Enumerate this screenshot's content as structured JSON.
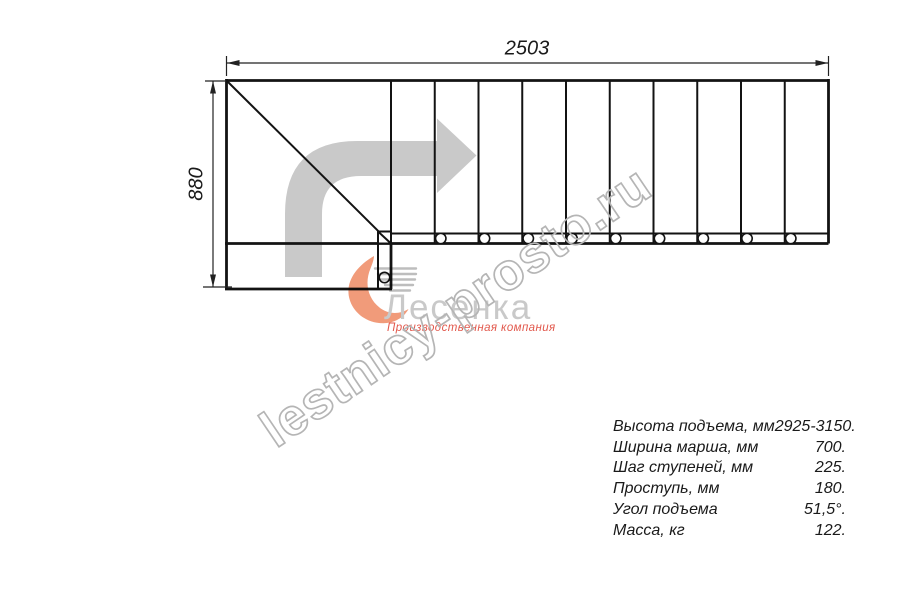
{
  "drawing": {
    "type": "staircase-top-view-plan",
    "dimension_width_mm": "2503",
    "dimension_height_mm": "880",
    "tread_count": 10,
    "baluster_count": 10,
    "direction_arrow": "up-then-right"
  },
  "watermark": {
    "text": "lestnicy-prosto.ru"
  },
  "logo": {
    "brand": "Лесенка",
    "tagline": "Производственная компания"
  },
  "specs": {
    "rows": [
      {
        "label": "Высота подъема, мм",
        "value": "2925-3150."
      },
      {
        "label": "Ширина марша, мм",
        "value": "700."
      },
      {
        "label": "Шаг ступеней, мм",
        "value": "225."
      },
      {
        "label": "Проступь, мм",
        "value": "180."
      },
      {
        "label": "Угол подъема",
        "value": "51,5°."
      },
      {
        "label": "Масса, кг",
        "value": "122."
      }
    ]
  },
  "colors": {
    "line": "#131313",
    "arrow_gray": "#c9c9c9",
    "watermark_gray": "#b5b5b5",
    "logo_text_gray": "#c9c9c9",
    "logo_accent_red": "#e2584c",
    "flame_orange": "#f0906b"
  }
}
